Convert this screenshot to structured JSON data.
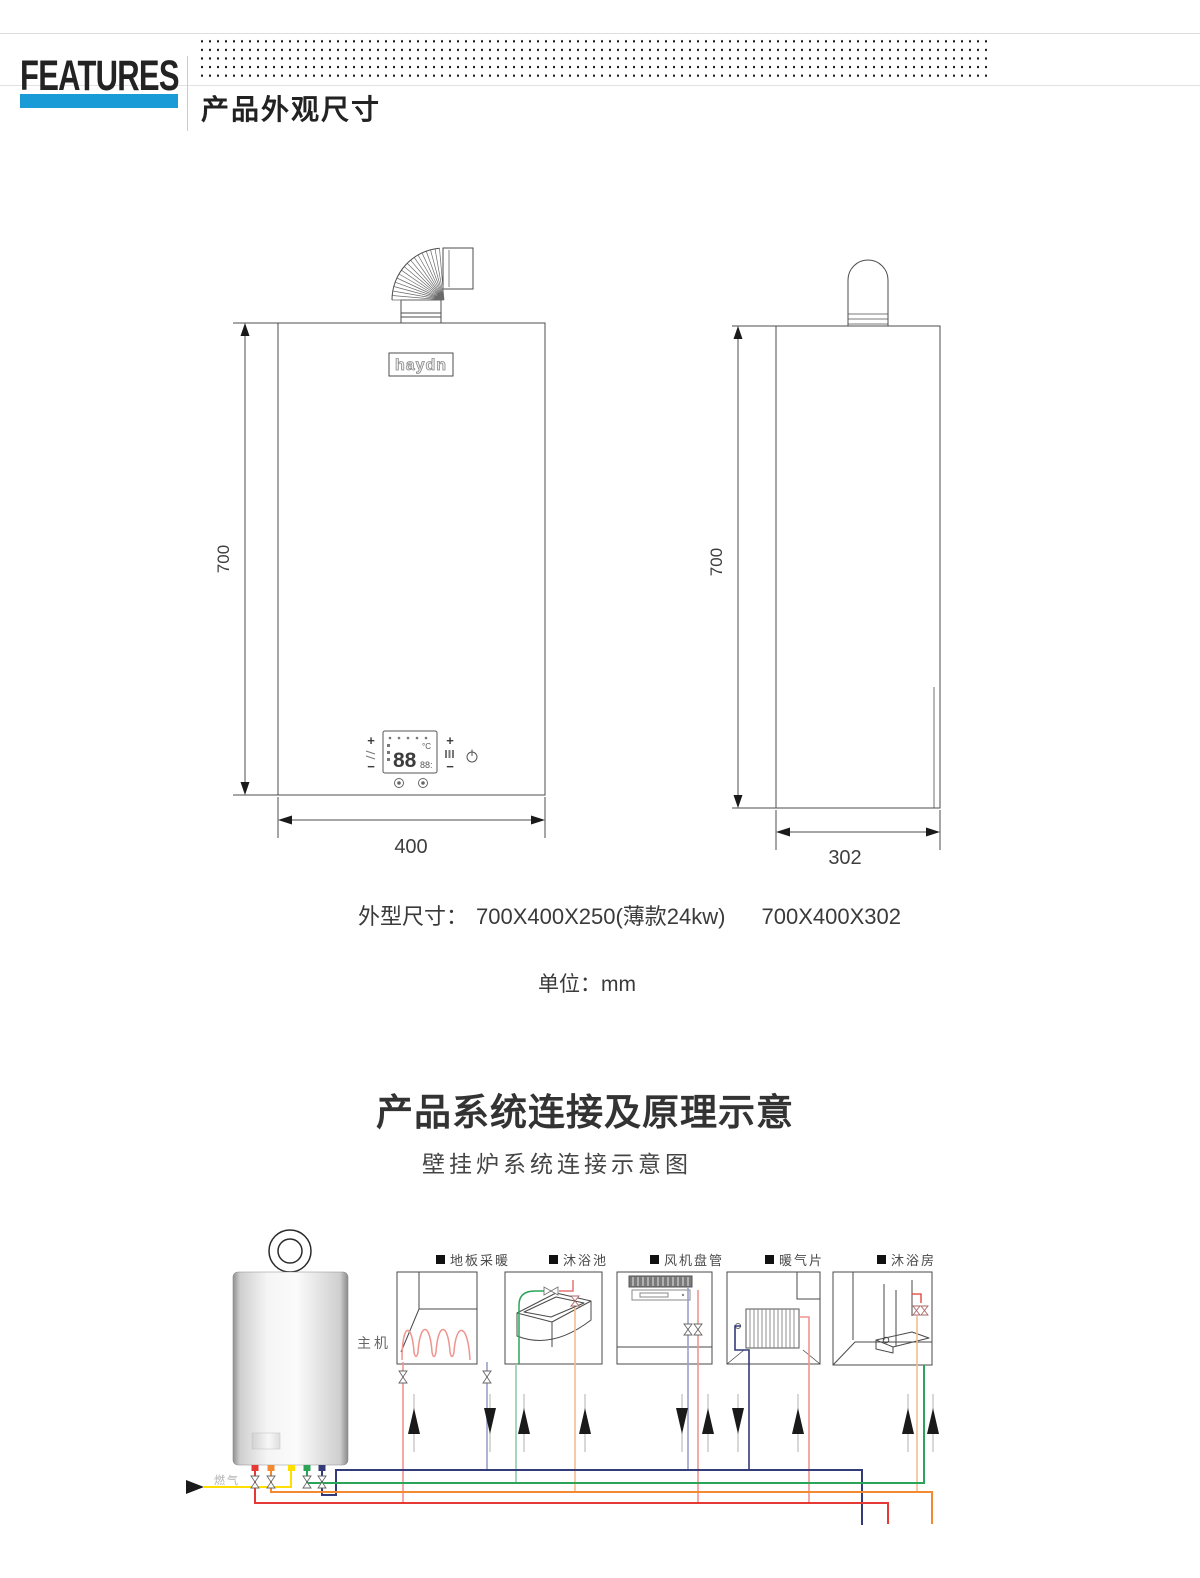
{
  "header": {
    "brand": "FEATURES",
    "section_title": "产品外观尺寸",
    "accent_color": "#189bd7"
  },
  "drawings": {
    "front": {
      "height_label": "700",
      "width_label": "400",
      "logo_text": "haydn",
      "control_panel": {
        "display_value": "88",
        "display_secondary": "88:",
        "unit": "°C",
        "plus": "+",
        "minus": "−"
      }
    },
    "side": {
      "height_label": "700",
      "width_label": "302"
    }
  },
  "specs": {
    "dimensions_label": "外型尺寸：",
    "dimensions_value_1": "700X400X250(薄款24kw)",
    "dimensions_value_2": "700X400X302",
    "unit_label": "单位：mm"
  },
  "system_section": {
    "title": "产品系统连接及原理示意",
    "subtitle": "壁挂炉系统连接示意图",
    "boiler_label": "主机",
    "gas_label": "燃气",
    "appliances": [
      {
        "label": "地板采暖"
      },
      {
        "label": "沐浴池"
      },
      {
        "label": "风机盘管"
      },
      {
        "label": "暖气片"
      },
      {
        "label": "沐浴房"
      }
    ],
    "pipe_colors": {
      "heating_supply_red": "#e53935",
      "heating_return_navy": "#333c78",
      "dhw_green": "#2aa558",
      "cold_water_orange": "#f18a31",
      "gas_yellow": "#ffdf00"
    }
  }
}
